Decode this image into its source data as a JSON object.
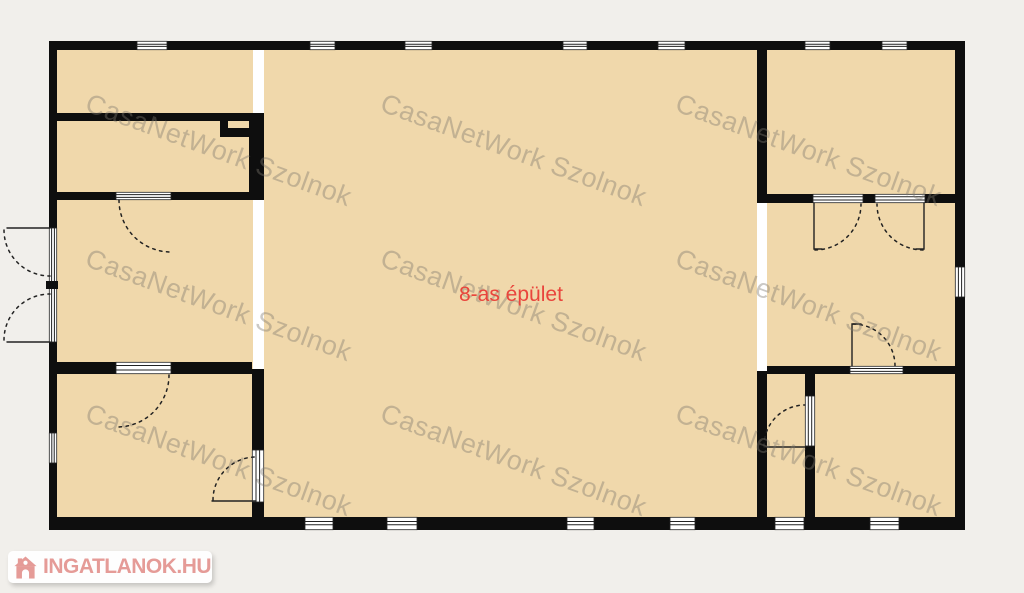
{
  "plan": {
    "label": "8-as épület",
    "label_color": "#e9453c",
    "room_fill": "#f0d8ab",
    "wall_color": "#0e0e0e",
    "background": "#f1efeb"
  },
  "watermark": {
    "text": "CasaNetWork Szolnok",
    "color": "rgba(125,119,111,0.40)",
    "instances": 9
  },
  "logo": {
    "text": "INGATLANOK.HU",
    "color": "#e59b97",
    "icon": "house-icon"
  }
}
